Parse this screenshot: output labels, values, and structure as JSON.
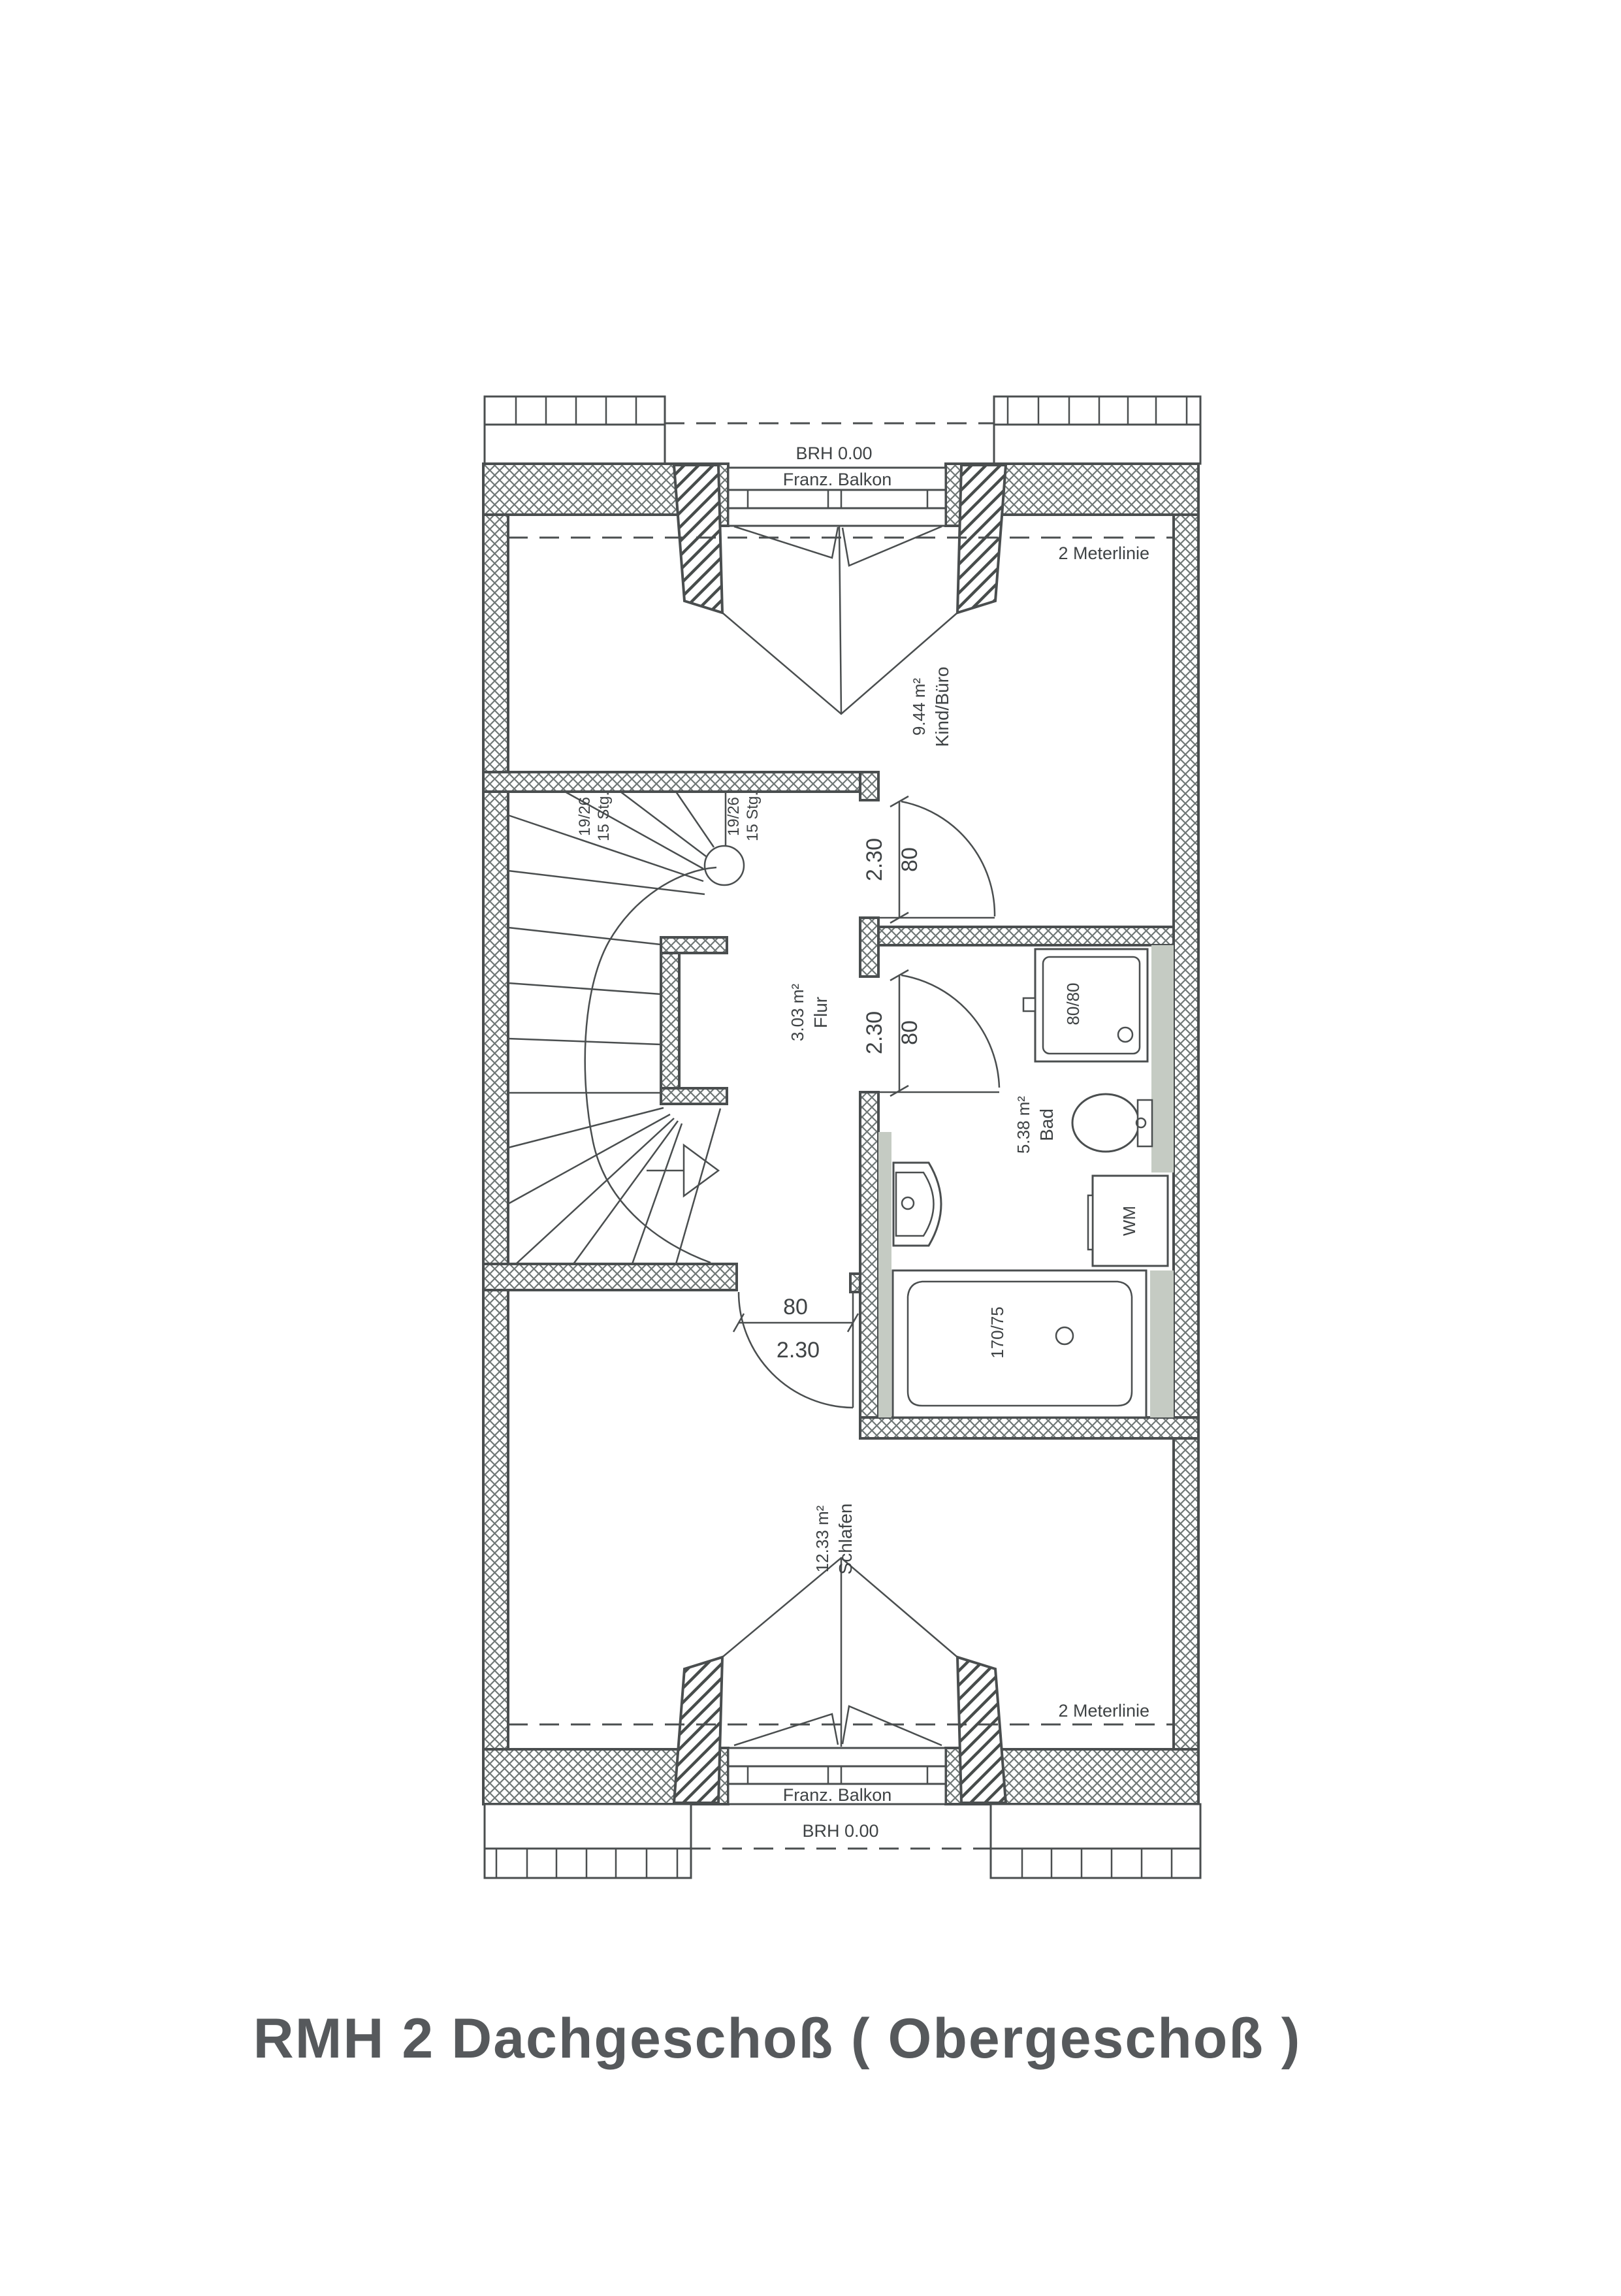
{
  "title": {
    "text": "RMH 2 Dachgeschoß ( Obergeschoß )"
  },
  "annotations": {
    "brh_top": "BRH 0.00",
    "brh_bottom": "BRH 0.00",
    "balcony_top": "Franz. Balkon",
    "balcony_bottom": "Franz. Balkon",
    "meterline_top": "2 Meterlinie",
    "meterline_bottom": "2 Meterlinie"
  },
  "rooms": {
    "kind": {
      "name": "Kind/Büro",
      "area": "9.44 m²"
    },
    "flur": {
      "name": "Flur",
      "area": "3.03 m²"
    },
    "bad": {
      "name": "Bad",
      "area": "5.38 m²"
    },
    "schlafen": {
      "name": "Schlafen",
      "area": "12.33 m²"
    }
  },
  "stairs": {
    "flight1": {
      "steps": "15 Stg.",
      "ratio": "19/26"
    },
    "flight2": {
      "steps": "15 Stg.",
      "ratio": "19/26"
    }
  },
  "doors": {
    "kind": {
      "width": "80",
      "height": "2.30"
    },
    "bad": {
      "width": "80",
      "height": "2.30"
    },
    "schlafen": {
      "width": "80",
      "height": "2.30"
    }
  },
  "fixtures": {
    "shower": {
      "label": "80/80"
    },
    "washing_machine": {
      "label": "WM"
    },
    "bathtub": {
      "label": "170/75"
    }
  },
  "colors": {
    "line": "#4a4e4f",
    "text": "#3f4345",
    "hatch": "#6f7776",
    "gray_fill": "#c5cbc3",
    "title": "#56595c"
  }
}
